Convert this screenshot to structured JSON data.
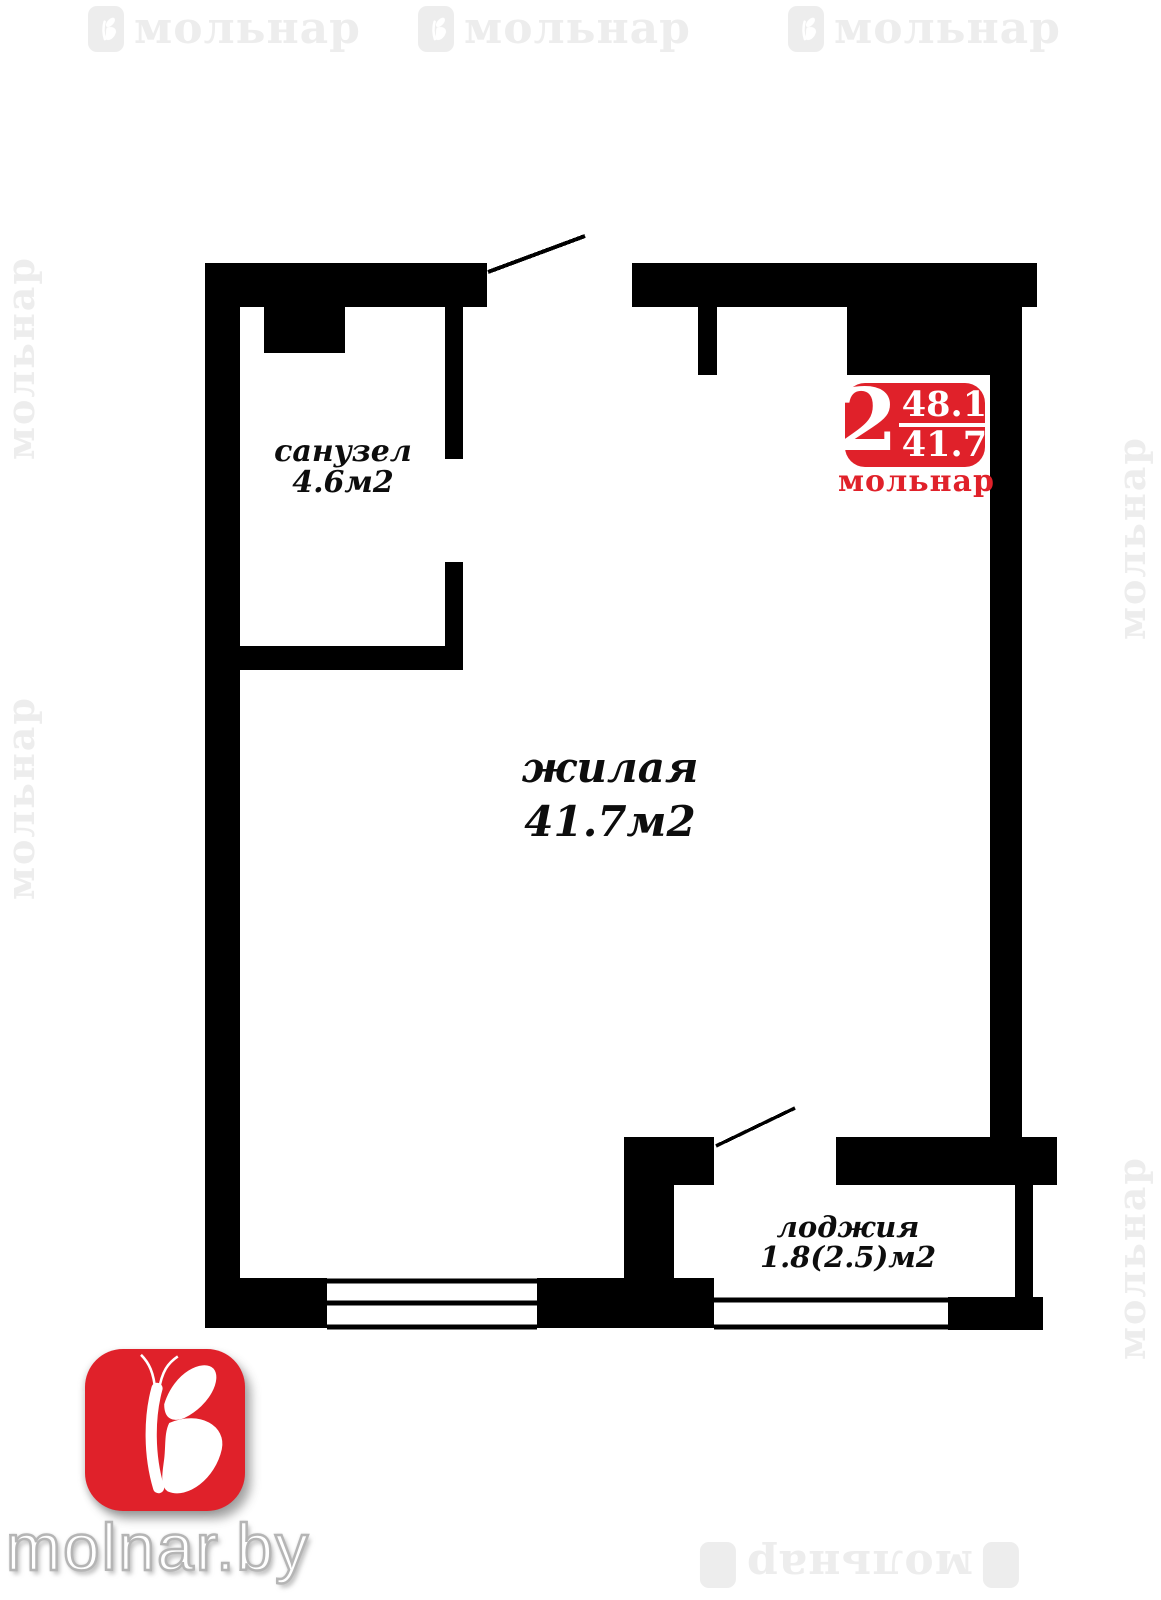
{
  "colors": {
    "wall": "#000000",
    "brand_red": "#e0212a",
    "watermark_gray": "#ededed"
  },
  "watermark": {
    "text": "мольнар"
  },
  "plan": {
    "rooms": {
      "bathroom": {
        "name": "санузел",
        "area": "4.6м2"
      },
      "living": {
        "name": "жилая",
        "area": "41.7м2"
      },
      "loggia": {
        "name": "лоджия",
        "area": "1.8(2.5)м2"
      }
    }
  },
  "badge": {
    "rooms_count": "2",
    "total_area": "48.1",
    "living_area": "41.7",
    "brand": "мольнар"
  },
  "footer": {
    "site": "molnar.by"
  }
}
